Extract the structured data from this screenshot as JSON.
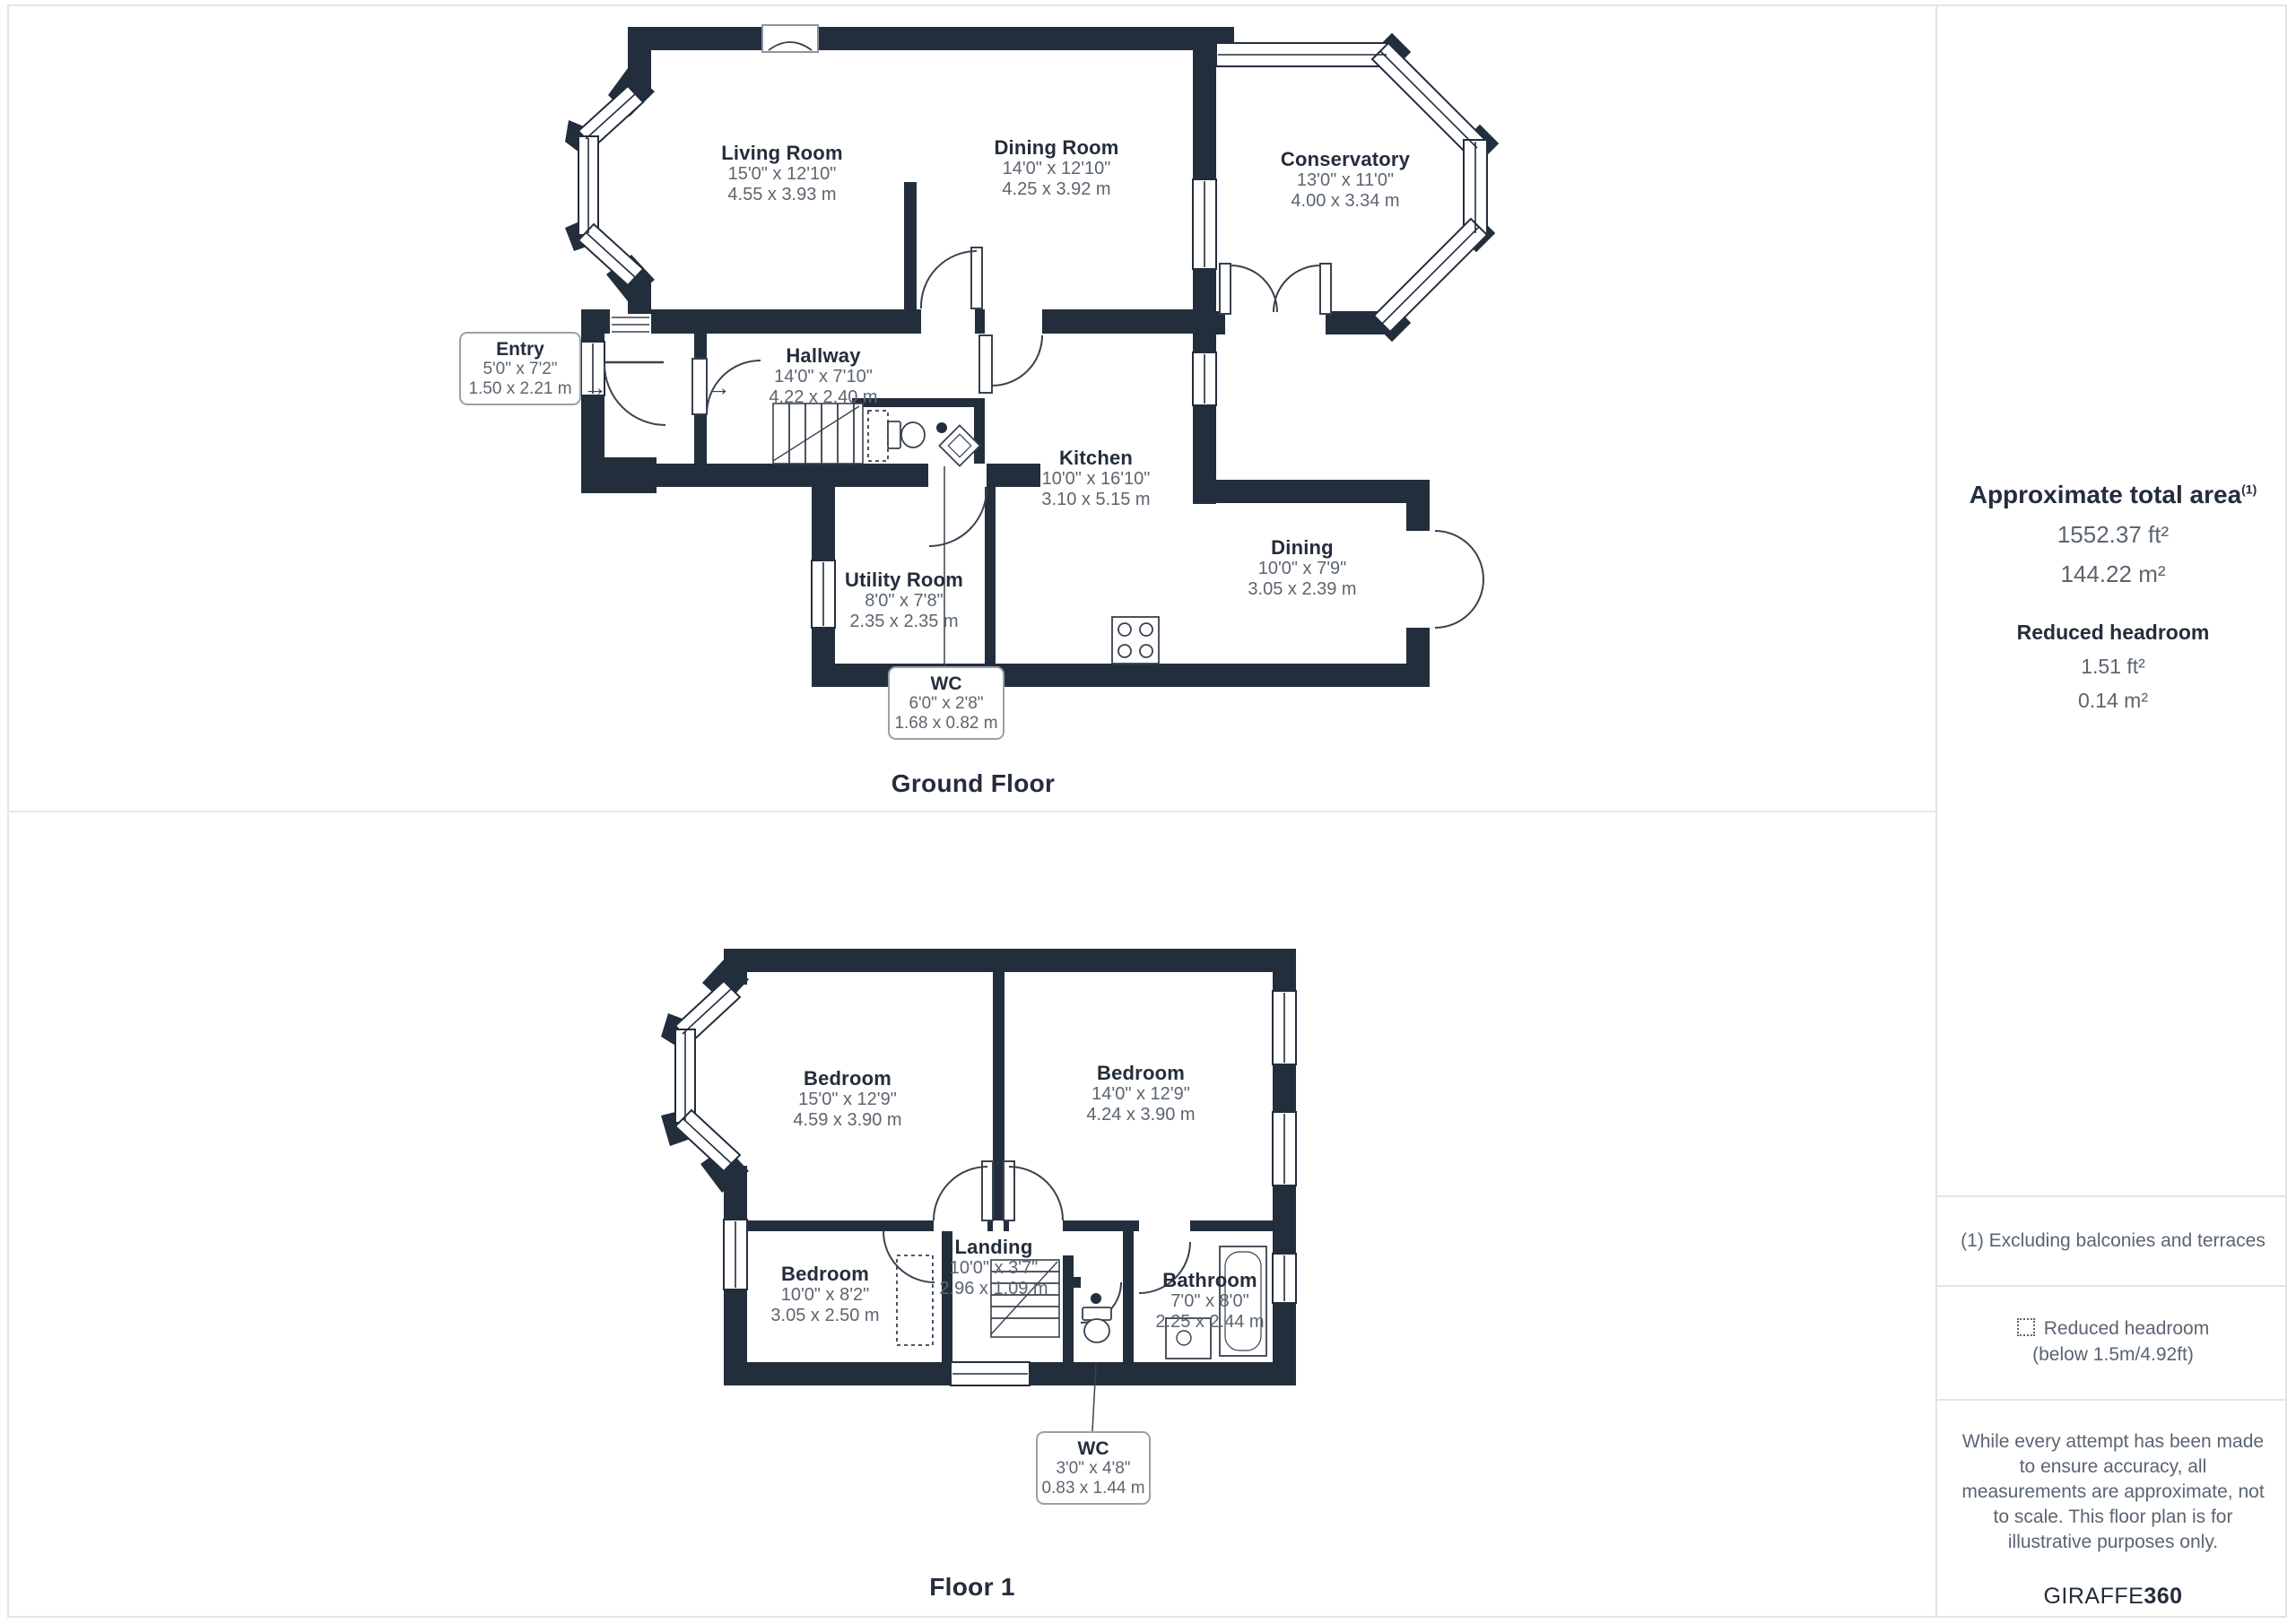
{
  "floors": [
    {
      "title": "Ground Floor",
      "rooms": [
        {
          "name": "Living Room",
          "ft": "15'0\" x 12'10\"",
          "m": "4.55 x 3.93 m"
        },
        {
          "name": "Dining Room",
          "ft": "14'0\" x 12'10\"",
          "m": "4.25 x 3.92 m"
        },
        {
          "name": "Conservatory",
          "ft": "13'0\" x 11'0\"",
          "m": "4.00 x 3.34 m"
        },
        {
          "name": "Hallway",
          "ft": "14'0\" x 7'10\"",
          "m": "4.22 x 2.40 m"
        },
        {
          "name": "Kitchen",
          "ft": "10'0\" x 16'10\"",
          "m": "3.10 x 5.15 m"
        },
        {
          "name": "Dining",
          "ft": "10'0\" x 7'9\"",
          "m": "3.05 x 2.39 m"
        },
        {
          "name": "Utility Room",
          "ft": "8'0\" x 7'8\"",
          "m": "2.35 x 2.35 m"
        }
      ],
      "callouts": [
        {
          "name": "Entry",
          "ft": "5'0\" x 7'2\"",
          "m": "1.50 x 2.21 m"
        },
        {
          "name": "WC",
          "ft": "6'0\" x 2'8\"",
          "m": "1.68 x 0.82 m"
        }
      ]
    },
    {
      "title": "Floor 1",
      "rooms": [
        {
          "name": "Bedroom",
          "ft": "15'0\" x 12'9\"",
          "m": "4.59 x 3.90 m"
        },
        {
          "name": "Bedroom",
          "ft": "14'0\" x 12'9\"",
          "m": "4.24 x 3.90 m"
        },
        {
          "name": "Bedroom",
          "ft": "10'0\" x 8'2\"",
          "m": "3.05 x 2.50 m"
        },
        {
          "name": "Landing",
          "ft": "10'0\" x 3'7\"",
          "m": "2.96 x 1.09 m"
        },
        {
          "name": "Bathroom",
          "ft": "7'0\" x 8'0\"",
          "m": "2.25 x 2.44 m"
        }
      ],
      "callouts": [
        {
          "name": "WC",
          "ft": "3'0\" x 4'8\"",
          "m": "0.83 x 1.44 m"
        }
      ]
    }
  ],
  "sidebar": {
    "total_area_label": "Approximate total area",
    "total_area_sup": "(1)",
    "total_ft": "1552.37 ft²",
    "total_m": "144.22 m²",
    "reduced_label": "Reduced headroom",
    "reduced_ft": "1.51 ft²",
    "reduced_m": "0.14 m²",
    "footnote": "(1) Excluding balconies and terraces",
    "legend_label": "Reduced headroom",
    "legend_sub": "(below 1.5m/4.92ft)",
    "disclaimer": "While every attempt has been made to ensure accuracy, all measurements are approximate, not to scale. This floor plan is for illustrative purposes only.",
    "brand_regular": "GIRAFFE",
    "brand_bold": "360"
  },
  "entry_arrow": "→",
  "colors": {
    "wall": "#232e3c",
    "dims": "#5c6570",
    "line": "#39424e"
  }
}
